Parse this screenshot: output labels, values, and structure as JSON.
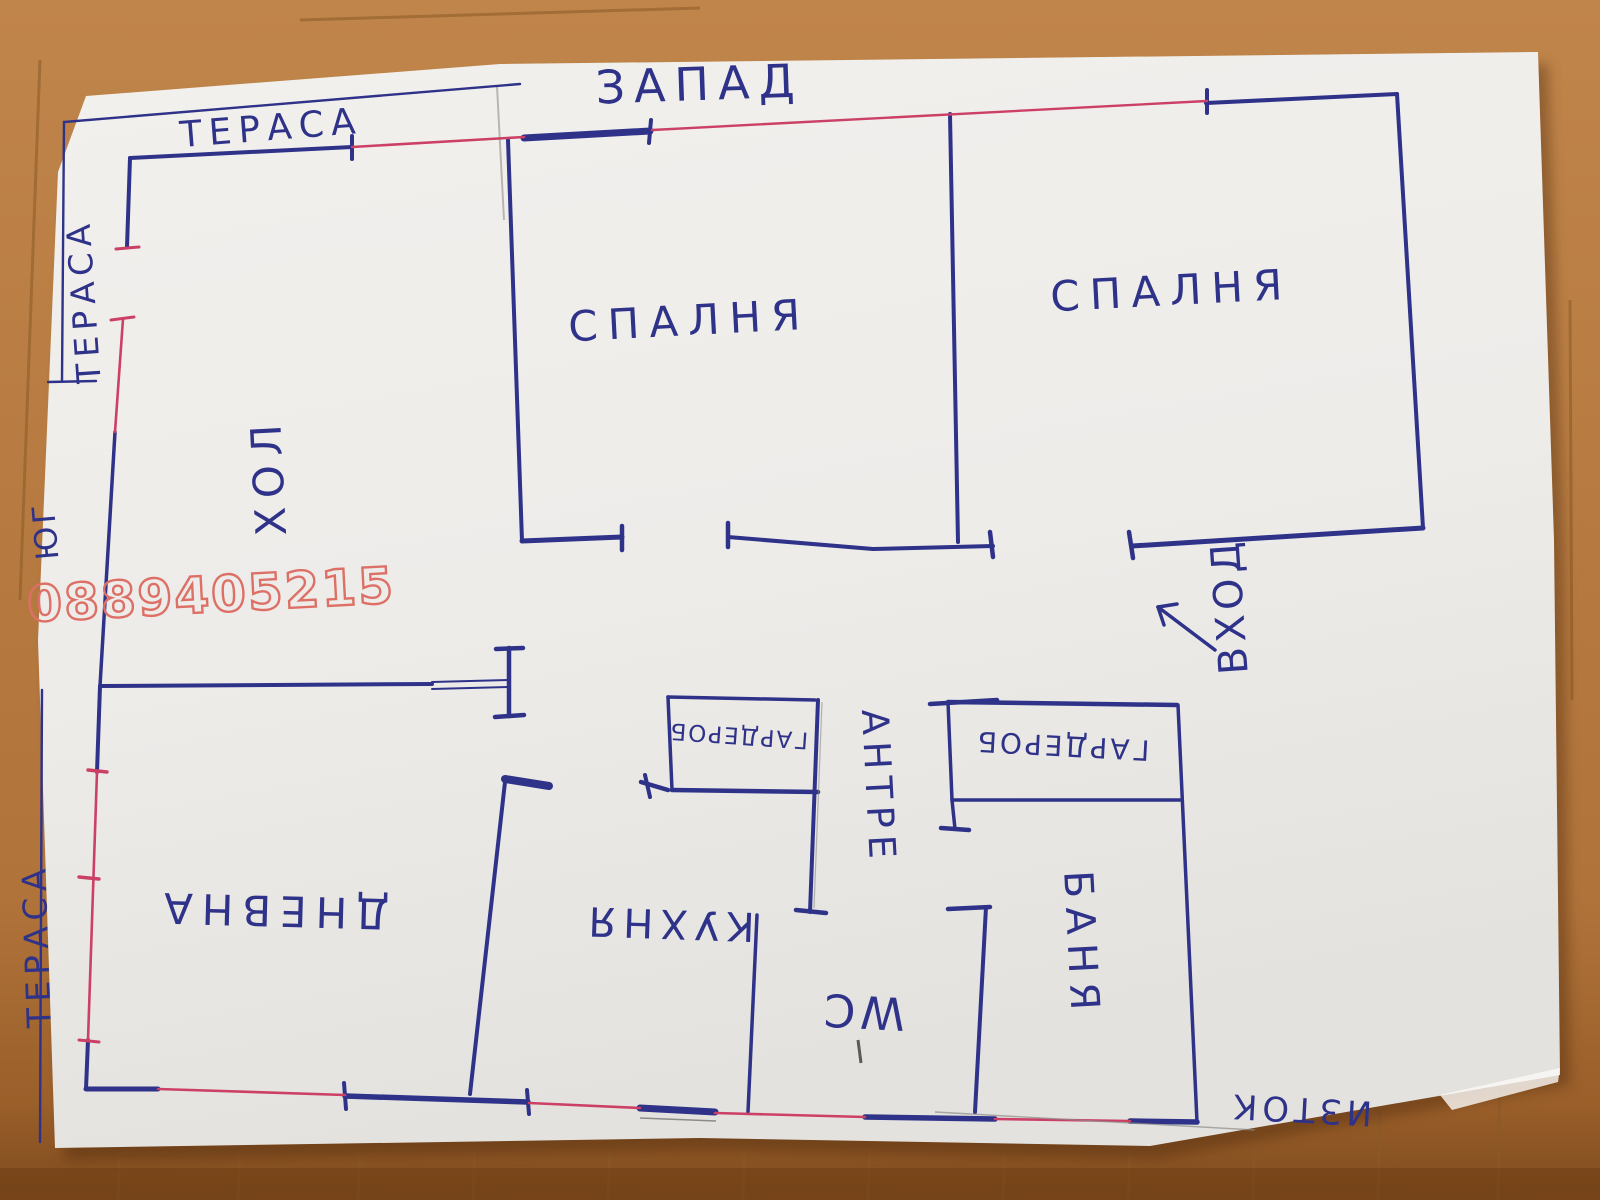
{
  "plan": {
    "compass": {
      "west": "ЗАПАД",
      "south": "ЮГ",
      "east": "ИЗТОК"
    },
    "labels": {
      "terrace_top": "ТЕРАСА",
      "terrace_left": "ТЕРАСА",
      "terrace_bottom": "ТЕРАСА",
      "bedroom_left": "СПАЛНЯ",
      "bedroom_right": "СПАЛНЯ",
      "hall": "ХОЛ",
      "entrance": "ВХОД",
      "entry_hall": "АНТРЕ",
      "wardrobe_left": "ГАРДЕРОБ",
      "wardrobe_right": "ГАРДЕРОБ",
      "bathroom": "БАНЯ",
      "wc": "WC",
      "kitchen": "КУХНЯ",
      "living_room": "ДНЕВНА"
    },
    "watermark": "0889405215",
    "colors": {
      "ink": "#2e3289",
      "window_red": "#cc4066",
      "watermark_red": "#dd7066",
      "paper": "#f0eeeb",
      "wood": "#b5793c"
    }
  }
}
